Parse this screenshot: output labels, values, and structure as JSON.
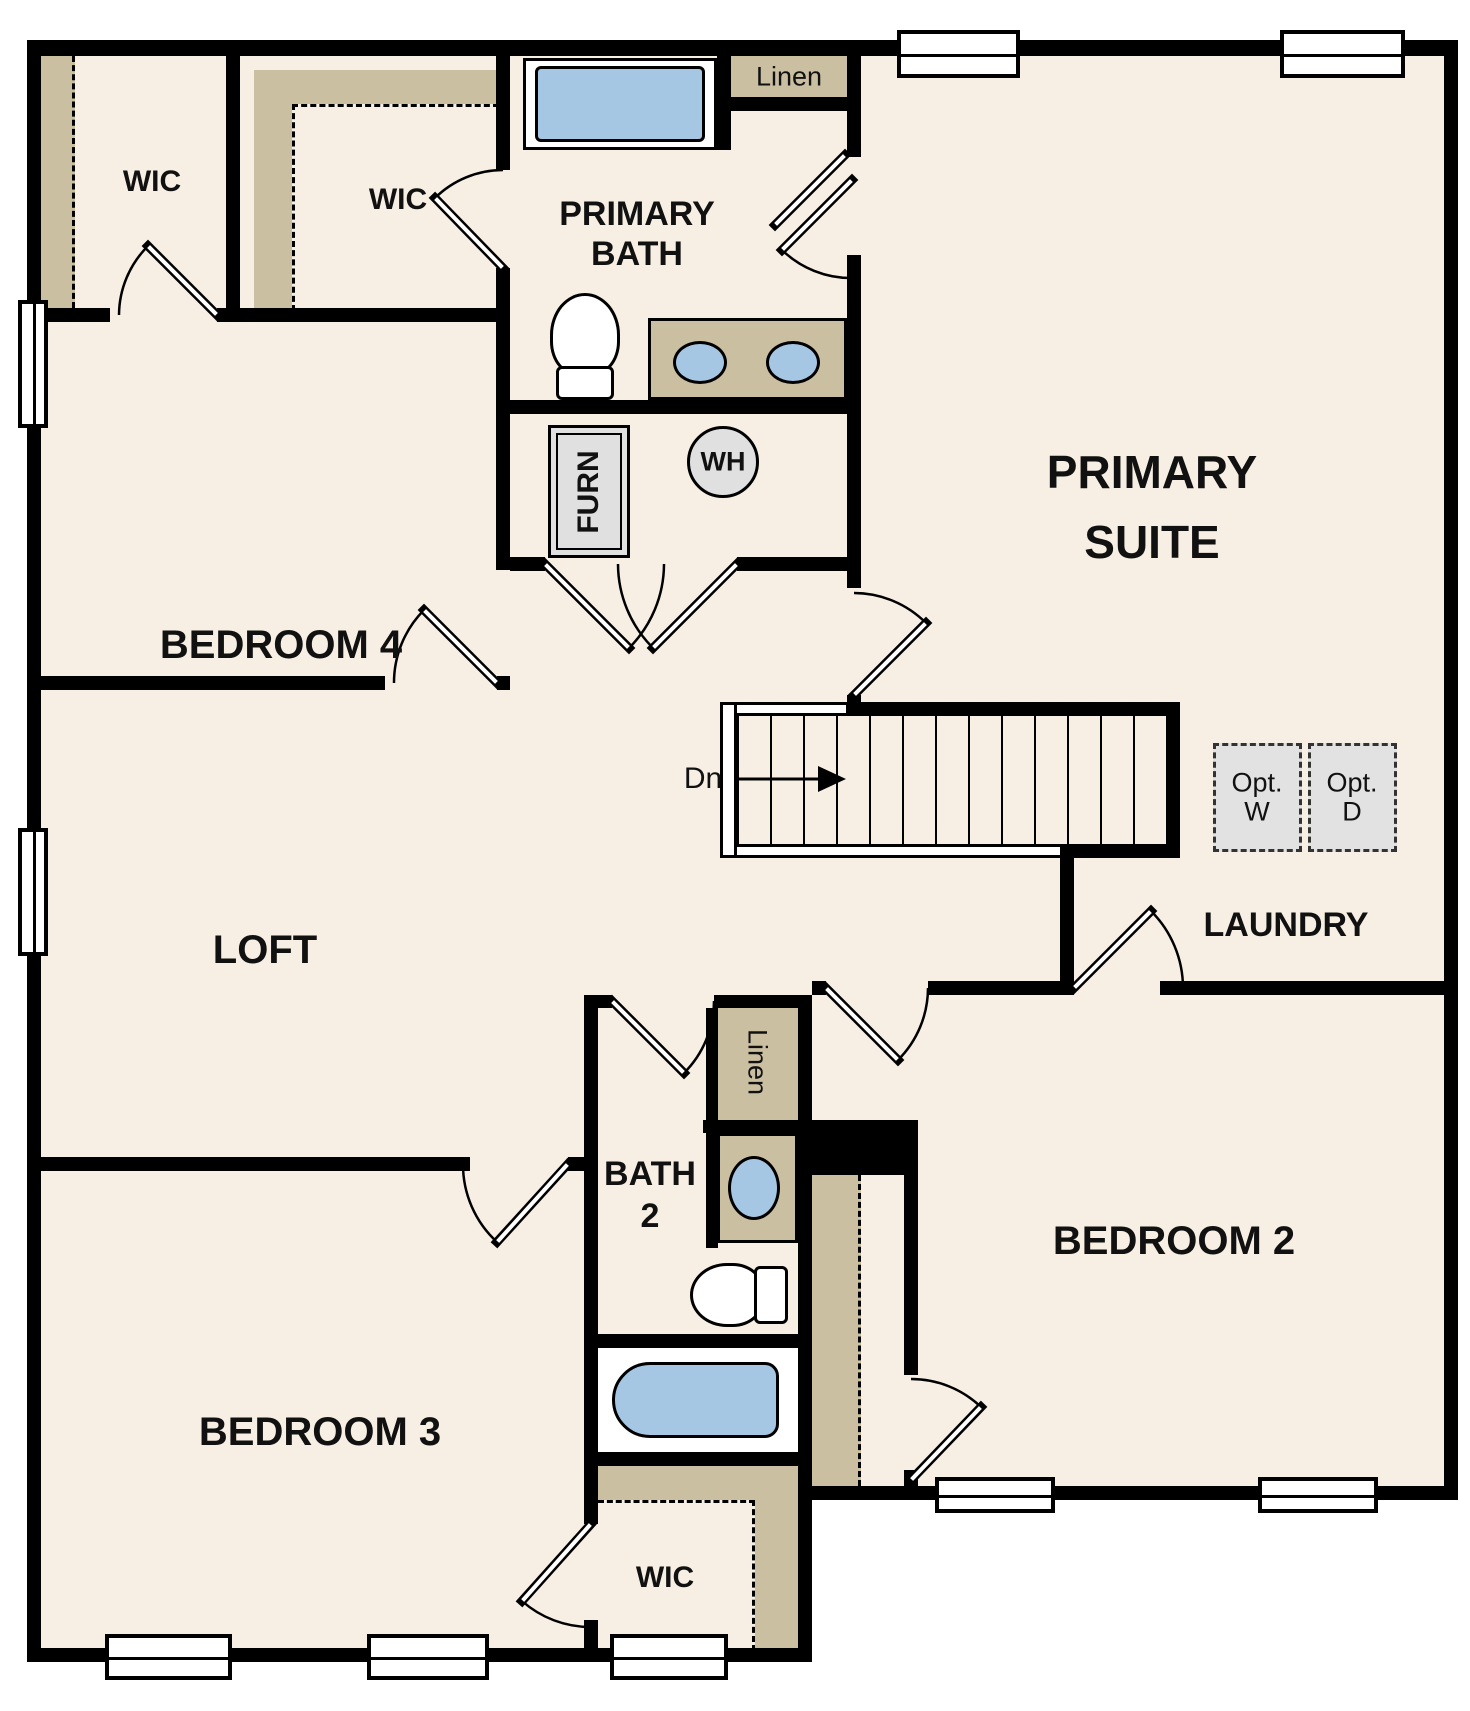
{
  "diagram_type": "residential-floor-plan-second-floor",
  "colors": {
    "wall": "#000000",
    "floor": "#f7efe3",
    "closet_shelf_tan": "#cbbfa2",
    "fixture_blue": "#a6c7e3",
    "appliance_gray": "#e0e0e0",
    "background": "#ffffff"
  },
  "rooms": [
    {
      "id": "wic-1",
      "label": "WIC"
    },
    {
      "id": "wic-2",
      "label": "WIC"
    },
    {
      "id": "primary-bath",
      "label": "PRIMARY BATH"
    },
    {
      "id": "primary-suite",
      "label": "PRIMARY SUITE"
    },
    {
      "id": "bedroom-4",
      "label": "BEDROOM 4"
    },
    {
      "id": "loft",
      "label": "LOFT"
    },
    {
      "id": "laundry",
      "label": "LAUNDRY"
    },
    {
      "id": "bath-2",
      "label": "BATH 2"
    },
    {
      "id": "bedroom-2",
      "label": "BEDROOM 2"
    },
    {
      "id": "bedroom-3",
      "label": "BEDROOM 3"
    },
    {
      "id": "wic-3",
      "label": "WIC"
    }
  ],
  "closets": [
    {
      "id": "linen-1",
      "label": "Linen"
    },
    {
      "id": "linen-2",
      "label": "Linen"
    }
  ],
  "equipment": [
    {
      "id": "furnace",
      "label": "FURN"
    },
    {
      "id": "water-heater",
      "label": "WH"
    },
    {
      "id": "optional-washer",
      "label": "Opt. W"
    },
    {
      "id": "optional-dryer",
      "label": "Opt. D"
    }
  ],
  "stairs": {
    "direction_label": "Dn"
  },
  "labels": {
    "wic1": "WIC",
    "wic2": "WIC",
    "wic3": "WIC",
    "primary_bath_1": "PRIMARY",
    "primary_bath_2": "BATH",
    "linen1": "Linen",
    "linen2": "Linen",
    "primary_suite_1": "PRIMARY",
    "primary_suite_2": "SUITE",
    "bedroom4": "BEDROOM 4",
    "loft": "LOFT",
    "laundry": "LAUNDRY",
    "bath2_1": "BATH",
    "bath2_2": "2",
    "bedroom2": "BEDROOM 2",
    "bedroom3": "BEDROOM 3",
    "furn": "FURN",
    "wh": "WH",
    "dn": "Dn",
    "optw_1": "Opt.",
    "optw_2": "W",
    "optd_1": "Opt.",
    "optd_2": "D"
  }
}
